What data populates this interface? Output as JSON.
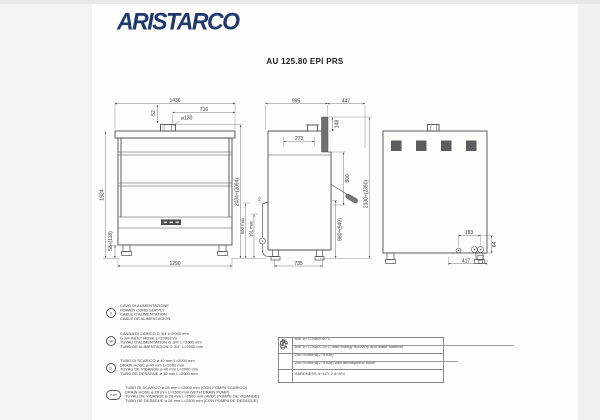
{
  "page": {
    "brand": "ARISTARCO",
    "title": "AU 125.80 EPI PRS",
    "brand_color": "#20386b",
    "line_color": "#4f4f4f"
  },
  "drawings": {
    "front": {
      "dims": {
        "total_width": "1436",
        "right_width": "716",
        "chimney_offset": "52",
        "chimney_dia": "⌀130",
        "body_height": "1924",
        "feet_height": "58÷(118)",
        "total_height": "2034÷(2094)",
        "base_width": "1290"
      }
    },
    "side": {
      "dims": {
        "depth": "995",
        "hood_extension": "447",
        "inner_width": "273",
        "hood_bar": "148",
        "hood_stroke": "800",
        "table_height": "880÷(940)",
        "total_height": "2330÷(2390)",
        "base_depth": "735",
        "drain_max": "600 max",
        "drain_min": "191 max",
        "gap": "10"
      }
    },
    "rear": {
      "dims": {
        "conn_offset_x": "183",
        "conn_offset_y": "64",
        "conn_base": "417"
      }
    }
  },
  "legend": {
    "items": [
      {
        "symbol": "E",
        "lines": [
          "CAVO DI ALIMENTAZIONE",
          "POWER CORD SUPPLY",
          "CABLE D'ALIMENTATION",
          "CABLE DE ALIMENTACION"
        ]
      },
      {
        "symbol": "W",
        "lines": [
          "CANNA DI CARICO G 3/4 L=2000 mm",
          "G 3/4 INLET HOSE L=2000 mm",
          "TUYAU D'ALIMENTATION G 3/4\" L=2000 mm",
          "TUBO DE ALIMENTACION G 3/4\" L=2000 mm"
        ]
      },
      {
        "symbol": "D",
        "lines": [
          "TUBO DI SCARICO ⌀ 40 mm L=2000 mm",
          "DRAIN HOSE ⌀ 40 mm L=2000 mm",
          "TUYAU DE VIDANGE ⌀ 40 mm L=2000 mm",
          "TUBO DE DESAGUE ⌀ 40 mm L=2000 mm"
        ]
      },
      {
        "symbol": "D-DP",
        "lines": [
          "TUBO DI SCARICO ⌀ 28 mm L=2500 mm (CON POMPA SCARICO)",
          "DRAIN HOSE ⌀ 28 mm L=2500 mm (WITH DRAIN PUMP)",
          "TUYAU DE VIDANGE ⌀ 28 mm L=2500 mm (AVEC POMPE DE VIDANGE)",
          "TUBO DE DESAGUE ⌀ 28 mm L=2500 mm (CON POMPA DE DESAGUE)"
        ]
      }
    ]
  },
  "spec_table": {
    "rows": [
      {
        "icon": "thermometer-icon",
        "text": "Min 10°C-MAX 60°C"
      },
      {
        "icon": "thermometer-icon",
        "text": "Min 10°C-MAX 25°C with energy recovery and water softener"
      },
      {
        "icon": "water-tap-icon",
        "text": "200÷500kPa(2÷5 Bar)"
      },
      {
        "icon": "water-tap-icon",
        "text": "200÷500kPa(2÷5 Bar) with atmospheric boiler"
      },
      {
        "icon": "water-drop-icon",
        "text": "HARDNESS 5÷14°f-2.8÷8°d"
      }
    ]
  }
}
